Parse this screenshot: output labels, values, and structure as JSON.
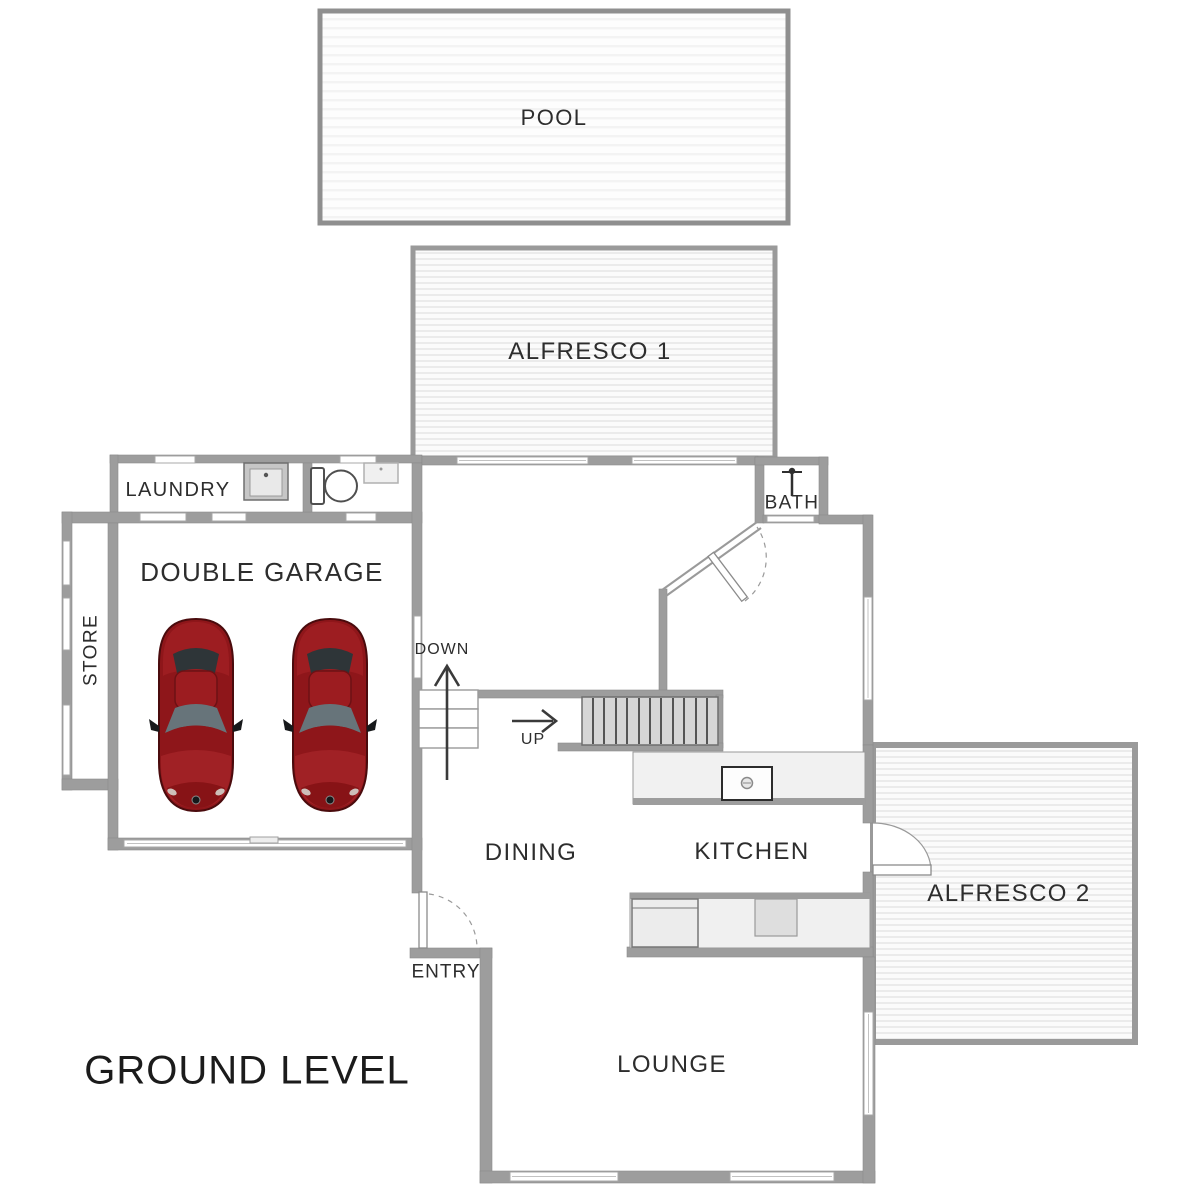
{
  "title": "GROUND LEVEL",
  "rooms": {
    "pool": {
      "label": "POOL"
    },
    "alfresco1": {
      "label": "ALFRESCO 1"
    },
    "laundry": {
      "label": "LAUNDRY"
    },
    "bath": {
      "label": "BATH"
    },
    "double_garage": {
      "label": "DOUBLE GARAGE"
    },
    "store": {
      "label": "STORE"
    },
    "dining": {
      "label": "DINING"
    },
    "kitchen": {
      "label": "KITCHEN"
    },
    "alfresco2": {
      "label": "ALFRESCO 2"
    },
    "lounge": {
      "label": "LOUNGE"
    },
    "entry": {
      "label": "ENTRY"
    }
  },
  "stairs": {
    "down_label": "DOWN",
    "up_label": "UP"
  },
  "icons": {
    "car": "car-icon",
    "toilet": "toilet-icon",
    "laundry_sink": "sink-icon",
    "shower": "shower-icon",
    "vanity": "vanity-icon",
    "island_sink": "island-sink-icon",
    "stove": "stove-icon",
    "down_arrow": "down-arrow-icon",
    "up_arrow": "up-arrow-icon"
  },
  "colors": {
    "wall": "#9d9d9d",
    "car_red": "#8e161a",
    "label_text": "#2d2d2d",
    "hatch_line": "#ebebeb",
    "stair_fill": "#d6d6d6"
  }
}
